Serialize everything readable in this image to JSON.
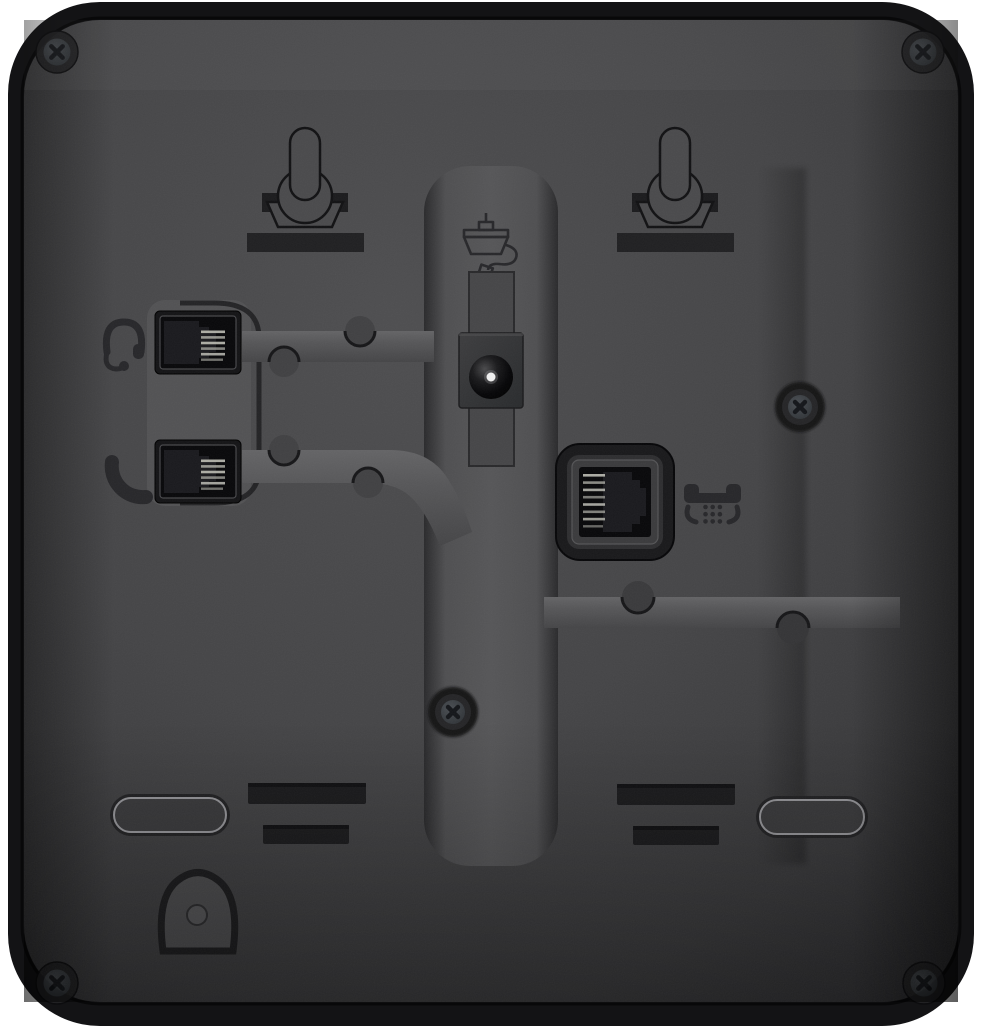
{
  "scene": {
    "type": "product-photo",
    "subject": "rear panel of a black desktop telephone",
    "background_color": "#ffffff"
  },
  "colors": {
    "bg": "#ffffff",
    "shell": "#131315",
    "panel": "#48484a",
    "panel_edge": "#2b2b2d",
    "recess": "#1b1b1d",
    "bar": "#202022",
    "keyhole": "#4a4a4c",
    "plate": "#525254",
    "socket": "#08080a",
    "pin": "#b5b5ad",
    "icon": "#27272a",
    "footline": "#96969a",
    "power_pin": "#f0f0f0",
    "screw_head": "#3e4246"
  },
  "features": {
    "wall_mount_keyholes": 2,
    "corner_screws": 4,
    "recessed_screws": 2,
    "vent_slots": 4,
    "rubber_feet": 2,
    "cable_hook": 1,
    "cable_channels": 3,
    "ports": [
      {
        "name": "headset-jack",
        "icon": "headset-icon"
      },
      {
        "name": "handset-jack",
        "icon": "handset-icon"
      },
      {
        "name": "dc-power-jack",
        "icon": "power-adapter-icon"
      },
      {
        "name": "phone-line-jack",
        "icon": "telephone-icon"
      }
    ]
  }
}
